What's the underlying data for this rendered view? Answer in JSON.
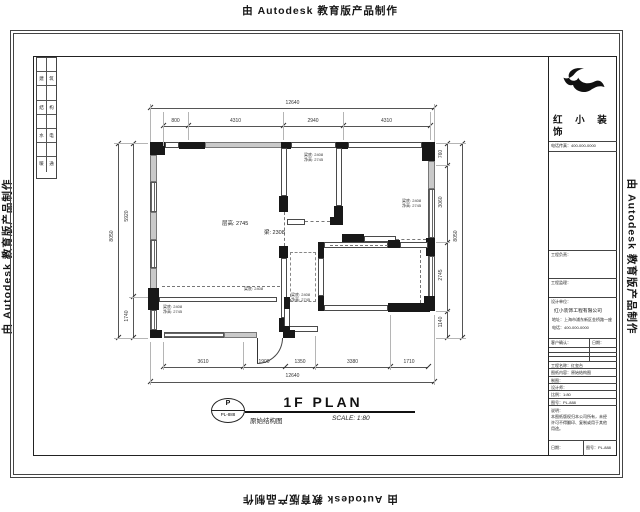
{
  "watermark": {
    "text": "由 Autodesk 教育版产品制作"
  },
  "signature_strip": {
    "rows": [
      [
        "",
        ""
      ],
      [
        "建",
        "筑"
      ],
      [
        "",
        ""
      ],
      [
        "结",
        "构"
      ],
      [
        "",
        ""
      ],
      [
        "水",
        "电"
      ],
      [
        "",
        ""
      ],
      [
        "暖",
        "通"
      ]
    ]
  },
  "title_block": {
    "brand_line1": "红 小 装",
    "brand_line2": "饰",
    "contact_row": "电话传真：400-000-0000",
    "row_a": "工程负责：",
    "row_b": "工程监理：",
    "company": {
      "header": "设计单位：",
      "name": "红小装饰工程有限公司",
      "address": "地址：上海市浦东新区金桥路一座",
      "phone": "电话：400-000-0000"
    },
    "confirm": {
      "left": "客户确认：",
      "right": "日期："
    },
    "info_rows": [
      "工程名称：红玺台",
      "图纸内容：原始结构图",
      "制图：",
      "设计师：",
      "比例：1:80",
      "图号：PL-888"
    ],
    "notes": [
      "说明：",
      "本图纸版权归本公司所有，未经",
      "许可不得翻印、复制或用于其他",
      "用途。"
    ],
    "bottom_left": "日期：",
    "bottom_right": "图号：PL-888"
  },
  "plan": {
    "labels": {
      "ceiling": "层高: 2745",
      "beam": "梁: 2308",
      "room_labels": [
        {
          "a": "梁底: 2408",
          "b": "净高: 2745"
        },
        {
          "a": "梁底: 2408",
          "b": "净高: 2745"
        },
        {
          "a": "梁底: 2408",
          "b": "净高: 2745"
        },
        {
          "a": "梁底: 2408",
          "b": "净高: 2745"
        },
        {
          "a": "梁底: 2408",
          "b": ""
        }
      ]
    },
    "title": {
      "bubble_top": "P",
      "bubble_bottom": "PL-888",
      "main": "1F PLAN",
      "sub": "原始结构图",
      "scale": "SCALE: 1:80"
    },
    "dims": {
      "top_total": "12640",
      "top_chain": [
        "800",
        "4310",
        "2940",
        "4310"
      ],
      "left_total": "8050",
      "left_chain": [
        "5920",
        "1740"
      ],
      "right_total": "8050",
      "right_chain": [
        "760",
        "3060",
        "2745",
        "1140"
      ],
      "bottom_chain": [
        "3610",
        "1900",
        "1350",
        "3380",
        "1710"
      ],
      "bottom_total": "12640"
    }
  }
}
